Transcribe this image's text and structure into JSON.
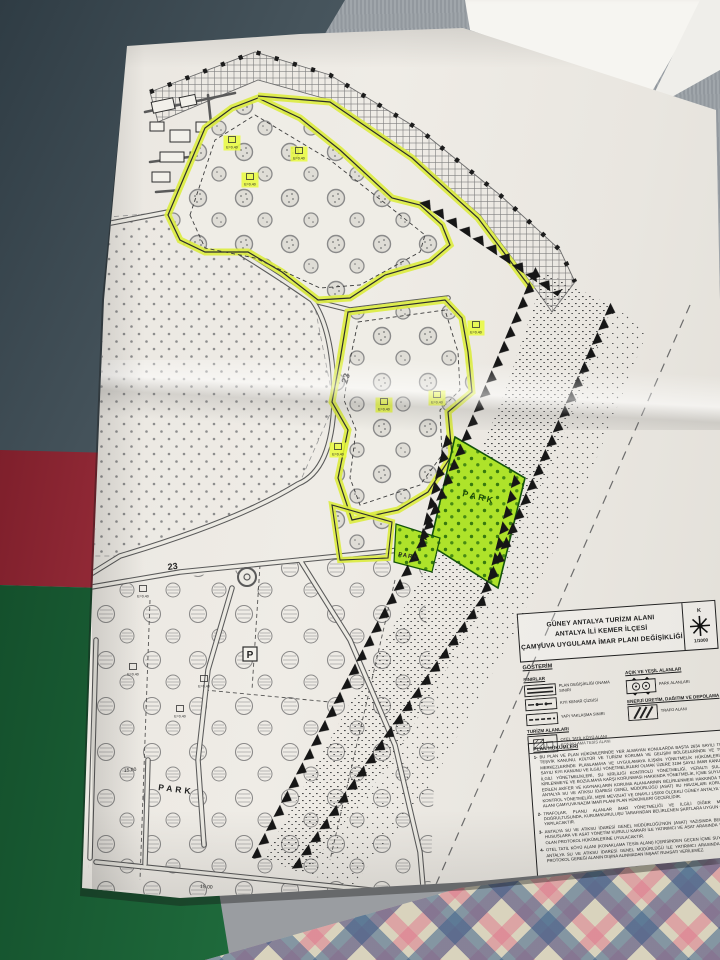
{
  "title_block": {
    "line1": "GÜNEY ANTALYA TURİZM ALANI",
    "line2": "ANTALYA İLİ KEMER İLÇESİ",
    "line3": "ÇAMYUVA UYGULAMA İMAR PLANI DEĞİŞİKLİĞİ",
    "north_letter": "K",
    "scale": "1/1000"
  },
  "legend": {
    "header": "GÖSTERİM",
    "sinirlar": {
      "header": "SINIRLAR",
      "items": [
        {
          "label": "PLAN DEĞİŞİKLİĞİ ONAMA SINIRI"
        },
        {
          "label": "KIYI KENAR ÇİZGİSİ"
        },
        {
          "label": "YAPI YAKLAŞMA SINIRI"
        }
      ]
    },
    "turizm": {
      "header": "TURİZM ALANLARI",
      "item_line1": "OTEL TATİL KÖYÜ ALANI",
      "item_line2": "KONAKLAMA TESİS ALANI"
    },
    "yesil": {
      "header": "AÇIK VE YEŞİL ALANLAR",
      "item": "PARK ALANLARI"
    },
    "enerji": {
      "header": "ENERJİ ÜRETİM, DAĞITIM VE DEPOLAMA",
      "item": "TRAFO ALANI"
    }
  },
  "plan_notes": {
    "header": "PLAN HÜKÜMLERİ",
    "items": [
      {
        "num": "1-",
        "text": "BU PLAN VE PLAN HÜKÜMLERİNDE YER ALMAYAN KONULARDA BAŞTA 2634 SAYILI TURİZM TEŞVİK KANUNU, KÜLTÜR VE TURİZM KORUMA VE GELİŞİM BÖLGELERİNDE VE TURİZM MERKEZLERİNDE PLANLAMAYA VE UYGULAMAYA İLİŞKİN YÖNETMELİK HÜKÜMLERİ, 3621 SAYILI KIYI KANUNU VE İLGİLİ YÖNETMELİKLERİ OLMAK ÜZERE 3194 SAYILI İMAR KANUNU VE İLGİLİ YÖNETMELİKLERİ, SU KİRLİLİĞİ KONTROLÜ YÖNETMELİĞİ, YERALTI SULARININ KİRLENMEYE VE BOZULMAYA KARŞI KORUNMASI HAKKINDA YÖNETMELİK, İÇME SUYU TEMİN EDİLEN AKİFER VE KAYNAKLARIN KORUMA ALANLARININ BELİRLENMESİ HAKKINDA TEBLİĞ, ANTALYA SU VE ATIKSU İDARESİ GENEL MÜDÜRLÜĞÜ (ASAT) SU HAVZALARI KORUMA VE KONTROL YÖNETMELİĞİ, MERİ MEVZUAT VE ONAYLI 1/5000 ÖLÇEKLİ GÜNEY ANTALYA TURİZM ALANI ÇAMYUVA NAZIM İMAR PLANI PLAN HÜKÜMLERİ GEÇERLİDİR."
      },
      {
        "num": "2-",
        "text": "TRAFOLAR, PLANLI ALANLAR İMAR YÖNETMELİĞİ VE İLGİLİ DİĞER MEVZUAT DOĞRULTUSUNDA, KURUM/KURULUŞU TARAFINDAN BELİRLENEN ŞARTLARA UYGUN OLARAK YAPILACAKTIR."
      },
      {
        "num": "3-",
        "text": "ANTALYA SU VE ATIKSU İDARESİ GENEL MÜDÜRLÜĞÜ'NÜN (ASAT) YAZISINDA BELİRTİLEN HUSUSLARA VE ASAT YÖNETİM KURULU KARARI İLE YATIRIMCI VE ASAT ARASINDA YAPILMIŞ OLAN PROTOKOL HÜKÜMLERİNE UYULACAKTIR."
      },
      {
        "num": "4-",
        "text": "OTEL TATİL KÖYÜ ALANI (KONAKLAMA TESİS ALANI) İÇERİSİNDEN GEÇEN İÇME SUYU HATTI, ANTALYA SU VE ATIKSU İDARESİ GENEL MÜDÜRLÜĞÜ İLE YATIRIMCI ARASINDA YAPILAN PROTOKOL GEREĞİ ALANIN DIŞINA ALINMADAN İNŞAAT RUHSATI VERİLEMEZ."
      }
    ]
  },
  "map_labels": {
    "park": "PARK",
    "road_number": "23",
    "parking": "P",
    "dim_15": "15.00",
    "parcel_code": "E=0.40"
  },
  "colors": {
    "highlighter": "#dcec3e",
    "park_green": "#aee32a",
    "paper": "#ebe8e2",
    "ink": "#2e2e2e"
  }
}
